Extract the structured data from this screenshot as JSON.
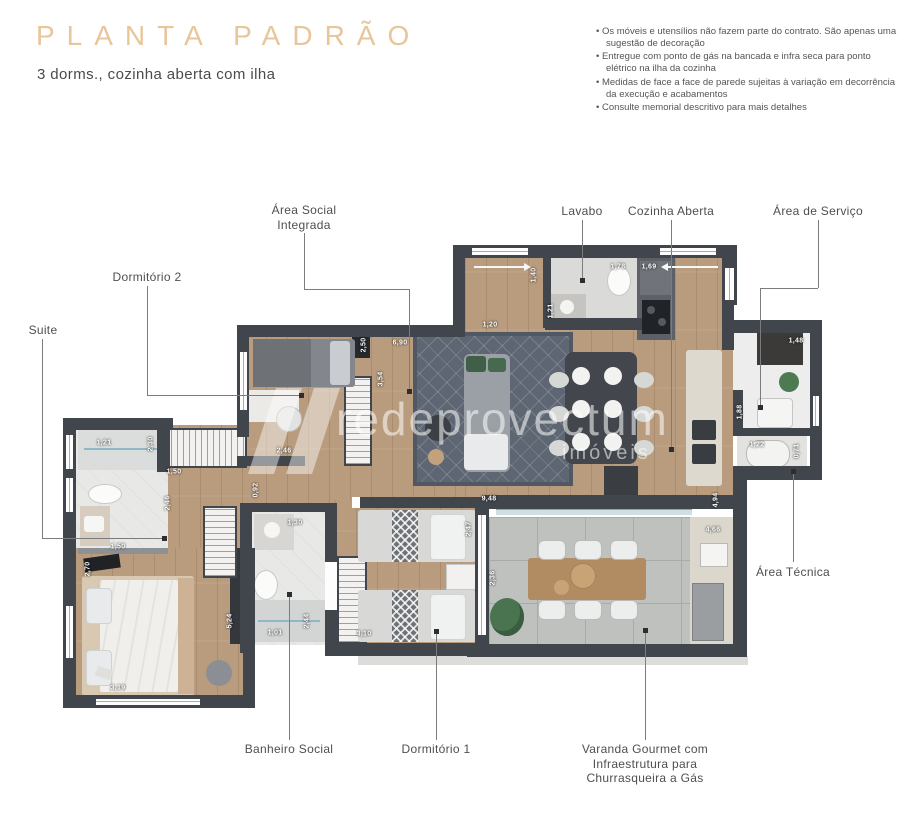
{
  "header": {
    "title": "PLANTA PADRÃO",
    "subtitle": "3 dorms., cozinha aberta com ilha",
    "notes": [
      "Os móveis e utensílios não fazem parte do contrato. São apenas uma sugestão de decoração",
      "Entregue com ponto de gás na bancada e infra seca para ponto elétrico na ilha da cozinha",
      "Medidas de face a face de parede sujeitas à variação em decorrência da execução e acabamentos",
      "Consulte memorial descritivo para mais detalhes"
    ]
  },
  "watermark": {
    "brand": "redeprovectum",
    "tagline": "imóveis"
  },
  "colors": {
    "accent_title": "#e8c59b",
    "wall": "#41464c",
    "wood_floor": "#b99c7e",
    "label_text": "#4f4f4f"
  },
  "plan": {
    "labels": [
      {
        "id": "area-social-integrada",
        "text": "Área Social Integrada",
        "cx": 304,
        "ty": 203,
        "w": 92,
        "segs": [
          [
            304,
            233,
            304,
            289
          ],
          [
            304,
            289,
            409,
            289
          ],
          [
            409,
            289,
            409,
            389
          ]
        ],
        "dot": [
          409,
          391
        ]
      },
      {
        "id": "dormitorio-2",
        "text": "Dormitório 2",
        "cx": 147,
        "ty": 270,
        "w": 120,
        "segs": [
          [
            147,
            286,
            147,
            395
          ],
          [
            147,
            395,
            299,
            395
          ]
        ],
        "dot": [
          301,
          395
        ]
      },
      {
        "id": "suite",
        "text": "Suite",
        "cx": 43,
        "ty": 323,
        "w": 60,
        "segs": [
          [
            42,
            339,
            42,
            538
          ],
          [
            42,
            538,
            162,
            538
          ]
        ],
        "dot": [
          164,
          538
        ]
      },
      {
        "id": "lavabo",
        "text": "Lavabo",
        "cx": 582,
        "ty": 204,
        "w": 70,
        "segs": [
          [
            582,
            220,
            582,
            279
          ]
        ],
        "dot": [
          582,
          280
        ]
      },
      {
        "id": "cozinha-aberta",
        "text": "Cozinha Aberta",
        "cx": 671,
        "ty": 204,
        "w": 110,
        "segs": [
          [
            671,
            220,
            671,
            447
          ]
        ],
        "dot": [
          671,
          449
        ]
      },
      {
        "id": "area-de-servico",
        "text": "Área de Serviço",
        "cx": 818,
        "ty": 204,
        "w": 110,
        "segs": [
          [
            818,
            220,
            818,
            288
          ],
          [
            760,
            288,
            818,
            288
          ],
          [
            760,
            288,
            760,
            405
          ]
        ],
        "dot": [
          760,
          407
        ]
      },
      {
        "id": "area-tecnica",
        "text": "Área Técnica",
        "cx": 793,
        "ty": 565,
        "w": 100,
        "segs": [
          [
            793,
            474,
            793,
            562
          ]
        ],
        "dot": [
          793,
          471
        ]
      },
      {
        "id": "banheiro-social",
        "text": "Banheiro Social",
        "cx": 289,
        "ty": 742,
        "w": 120,
        "segs": [
          [
            289,
            596,
            289,
            740
          ]
        ],
        "dot": [
          289,
          594
        ]
      },
      {
        "id": "dormitorio-1",
        "text": "Dormitório 1",
        "cx": 436,
        "ty": 742,
        "w": 100,
        "segs": [
          [
            436,
            634,
            436,
            740
          ]
        ],
        "dot": [
          436,
          631
        ]
      },
      {
        "id": "varanda-gourmet",
        "text": "Varanda Gourmet com Infraestrutura para Churrasqueira a Gás",
        "cx": 645,
        "ty": 742,
        "w": 134,
        "segs": [
          [
            645,
            633,
            645,
            740
          ]
        ],
        "dot": [
          645,
          630
        ]
      }
    ],
    "dimensions": [
      {
        "t": "2,50",
        "x": 364,
        "y": 345,
        "r": 1
      },
      {
        "t": "6,90",
        "x": 400,
        "y": 343,
        "r": 0
      },
      {
        "t": "3,54",
        "x": 381,
        "y": 379,
        "r": 1
      },
      {
        "t": "2,46",
        "x": 284,
        "y": 451,
        "r": 0
      },
      {
        "t": "1,50",
        "x": 174,
        "y": 472,
        "r": 0
      },
      {
        "t": "1,21",
        "x": 104,
        "y": 443,
        "r": 0
      },
      {
        "t": "2,30",
        "x": 151,
        "y": 444,
        "r": 1
      },
      {
        "t": "0,92",
        "x": 256,
        "y": 490,
        "r": 1
      },
      {
        "t": "2,46",
        "x": 168,
        "y": 503,
        "r": 1
      },
      {
        "t": "1,50",
        "x": 118,
        "y": 547,
        "r": 0
      },
      {
        "t": "2,70",
        "x": 88,
        "y": 569,
        "r": 1
      },
      {
        "t": "5,24",
        "x": 230,
        "y": 621,
        "r": 1
      },
      {
        "t": "3,19",
        "x": 118,
        "y": 688,
        "r": 0
      },
      {
        "t": "1,01",
        "x": 275,
        "y": 633,
        "r": 0
      },
      {
        "t": "2,44",
        "x": 307,
        "y": 621,
        "r": 1
      },
      {
        "t": "1,30",
        "x": 295,
        "y": 523,
        "r": 0
      },
      {
        "t": "3,10",
        "x": 364,
        "y": 634,
        "r": 0
      },
      {
        "t": "2,47",
        "x": 469,
        "y": 529,
        "r": 1
      },
      {
        "t": "2,36",
        "x": 493,
        "y": 578,
        "r": 1
      },
      {
        "t": "9,48",
        "x": 489,
        "y": 499,
        "r": 0
      },
      {
        "t": "4,66",
        "x": 713,
        "y": 530,
        "r": 0
      },
      {
        "t": "4,94",
        "x": 716,
        "y": 500,
        "r": 1
      },
      {
        "t": "1,40",
        "x": 534,
        "y": 275,
        "r": 1
      },
      {
        "t": "1,78",
        "x": 618,
        "y": 267,
        "r": 0
      },
      {
        "t": "1,69",
        "x": 649,
        "y": 267,
        "r": 0
      },
      {
        "t": "1,20",
        "x": 490,
        "y": 325,
        "r": 0
      },
      {
        "t": "1,21",
        "x": 551,
        "y": 311,
        "r": 1
      },
      {
        "t": "1,48",
        "x": 796,
        "y": 341,
        "r": 0
      },
      {
        "t": "1,88",
        "x": 740,
        "y": 412,
        "r": 1
      },
      {
        "t": "1,22",
        "x": 757,
        "y": 445,
        "r": 0
      },
      {
        "t": "0,71",
        "x": 797,
        "y": 451,
        "r": 1
      }
    ]
  }
}
